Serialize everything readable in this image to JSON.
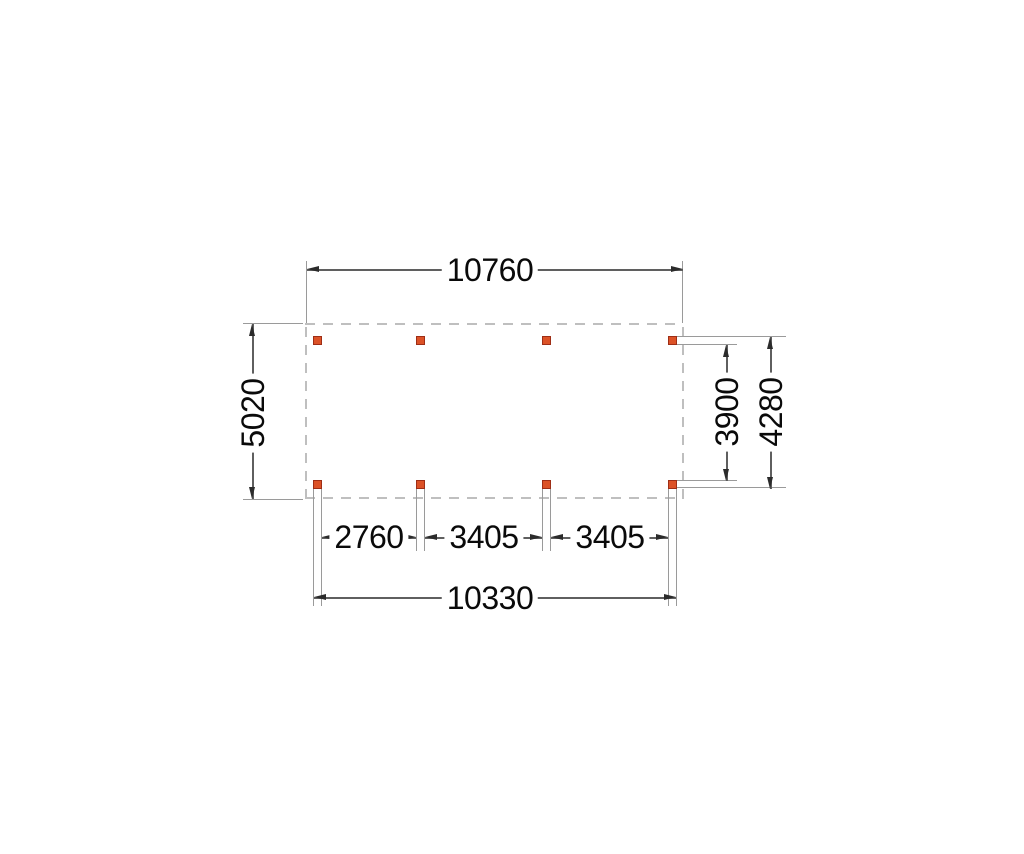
{
  "drawing": {
    "colors": {
      "background": "#ffffff",
      "post_fill": "#dc5227",
      "post_border": "#9e2e16",
      "dimension_line": "#5f5f5f",
      "extension_line": "#9a9a9a",
      "arrow": "#2b2b2b",
      "outline_dash": "#bfbfbf",
      "text": "#0a0a0a"
    },
    "dimensions": {
      "top_overall_width": "10760",
      "left_overall_depth": "5020",
      "right_inner_depth": "3900",
      "right_outer_depth": "4280",
      "bottom_bay_1": "2760",
      "bottom_bay_2": "3405",
      "bottom_bay_3": "3405",
      "bottom_overall_width": "10330"
    },
    "posts": {
      "count": 8,
      "rows": 2,
      "columns": 4
    }
  }
}
